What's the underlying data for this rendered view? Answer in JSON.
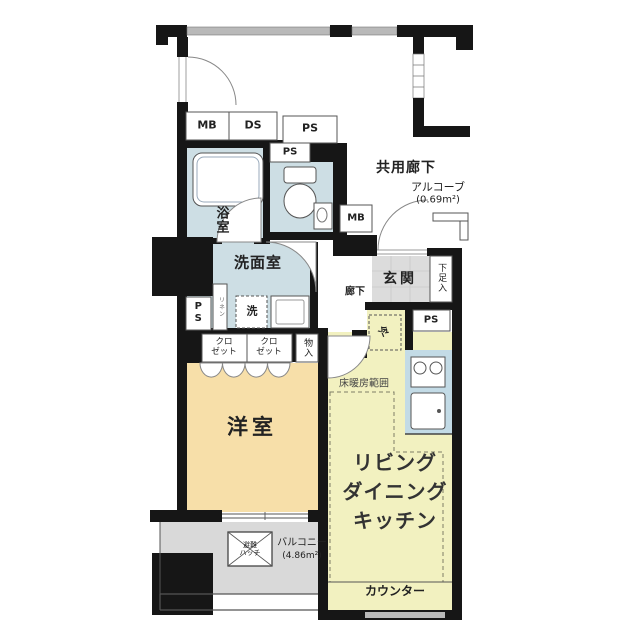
{
  "plan": {
    "common": {
      "corridor_label": "共用廊下",
      "alcove_label": "アルコーブ",
      "alcove_area": "(0.69m²)"
    },
    "service": {
      "mb_top": "MB",
      "ds_top": "DS",
      "ps_top": "PS",
      "ps_toilet": "PS",
      "ps_left": "PS",
      "ps_kitchen": "PS",
      "mb_entry": "MB"
    },
    "rooms": {
      "bath": {
        "label": "浴室"
      },
      "washroom": {
        "label": "洗面室",
        "washer": "洗",
        "linen": "リネン"
      },
      "hall": {
        "label": "廊下"
      },
      "entrance": {
        "label": "玄関",
        "shoe_box": "下足入"
      },
      "western": {
        "label": "洋室"
      },
      "closet1": {
        "label": "クロ\nゼット"
      },
      "closet2": {
        "label": "クロ\nゼット"
      },
      "storage": {
        "label": "物入"
      },
      "ldk": {
        "line1": "リビング",
        "line2": "ダイニング",
        "line3": "キッチン",
        "floor_heating": "床暖房範囲",
        "counter": "カウンター",
        "fridge": "冷"
      },
      "balcony": {
        "label": "バルコニー",
        "area": "(4.86m²)",
        "hatch": "避難\nハッチ"
      }
    },
    "colors": {
      "wet_room": "#cddee4",
      "kitchen_counter": "#c3dbe6",
      "western_room": "#f7dfa9",
      "ldk_floor": "#f2f1c0",
      "entrance_tile": "#dcdcdc",
      "balcony_floor": "#d9d9d9",
      "wall": "#161616"
    }
  }
}
